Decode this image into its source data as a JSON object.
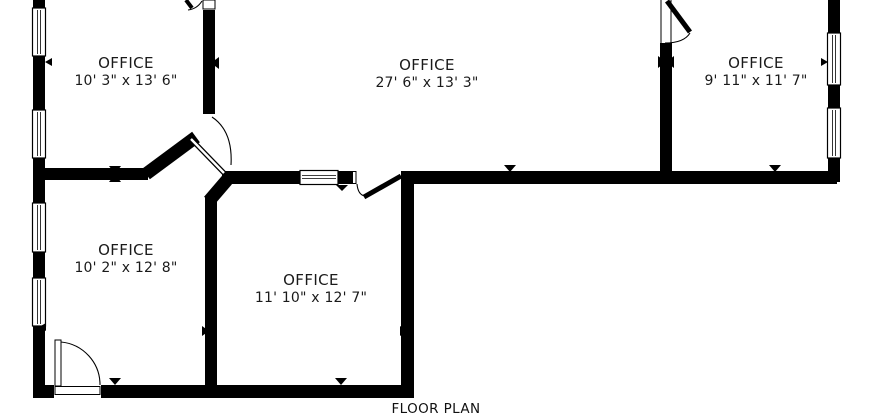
{
  "title": "FLOOR PLAN",
  "rooms": [
    {
      "id": "office-top-left",
      "label": "OFFICE",
      "dimensions": "10' 3\" x 13' 6\""
    },
    {
      "id": "office-middle",
      "label": "OFFICE",
      "dimensions": "27' 6\" x 13' 3\""
    },
    {
      "id": "office-top-right",
      "label": "OFFICE",
      "dimensions": "9' 11\" x 11' 7\""
    },
    {
      "id": "office-bottom-left",
      "label": "OFFICE",
      "dimensions": "10' 2\" x 12' 8\""
    },
    {
      "id": "office-bottom-middle",
      "label": "OFFICE",
      "dimensions": "11' 10\" x 12' 7\""
    }
  ],
  "colors": {
    "wall": "#000000",
    "background": "#ffffff",
    "text": "#1a1a1a"
  }
}
